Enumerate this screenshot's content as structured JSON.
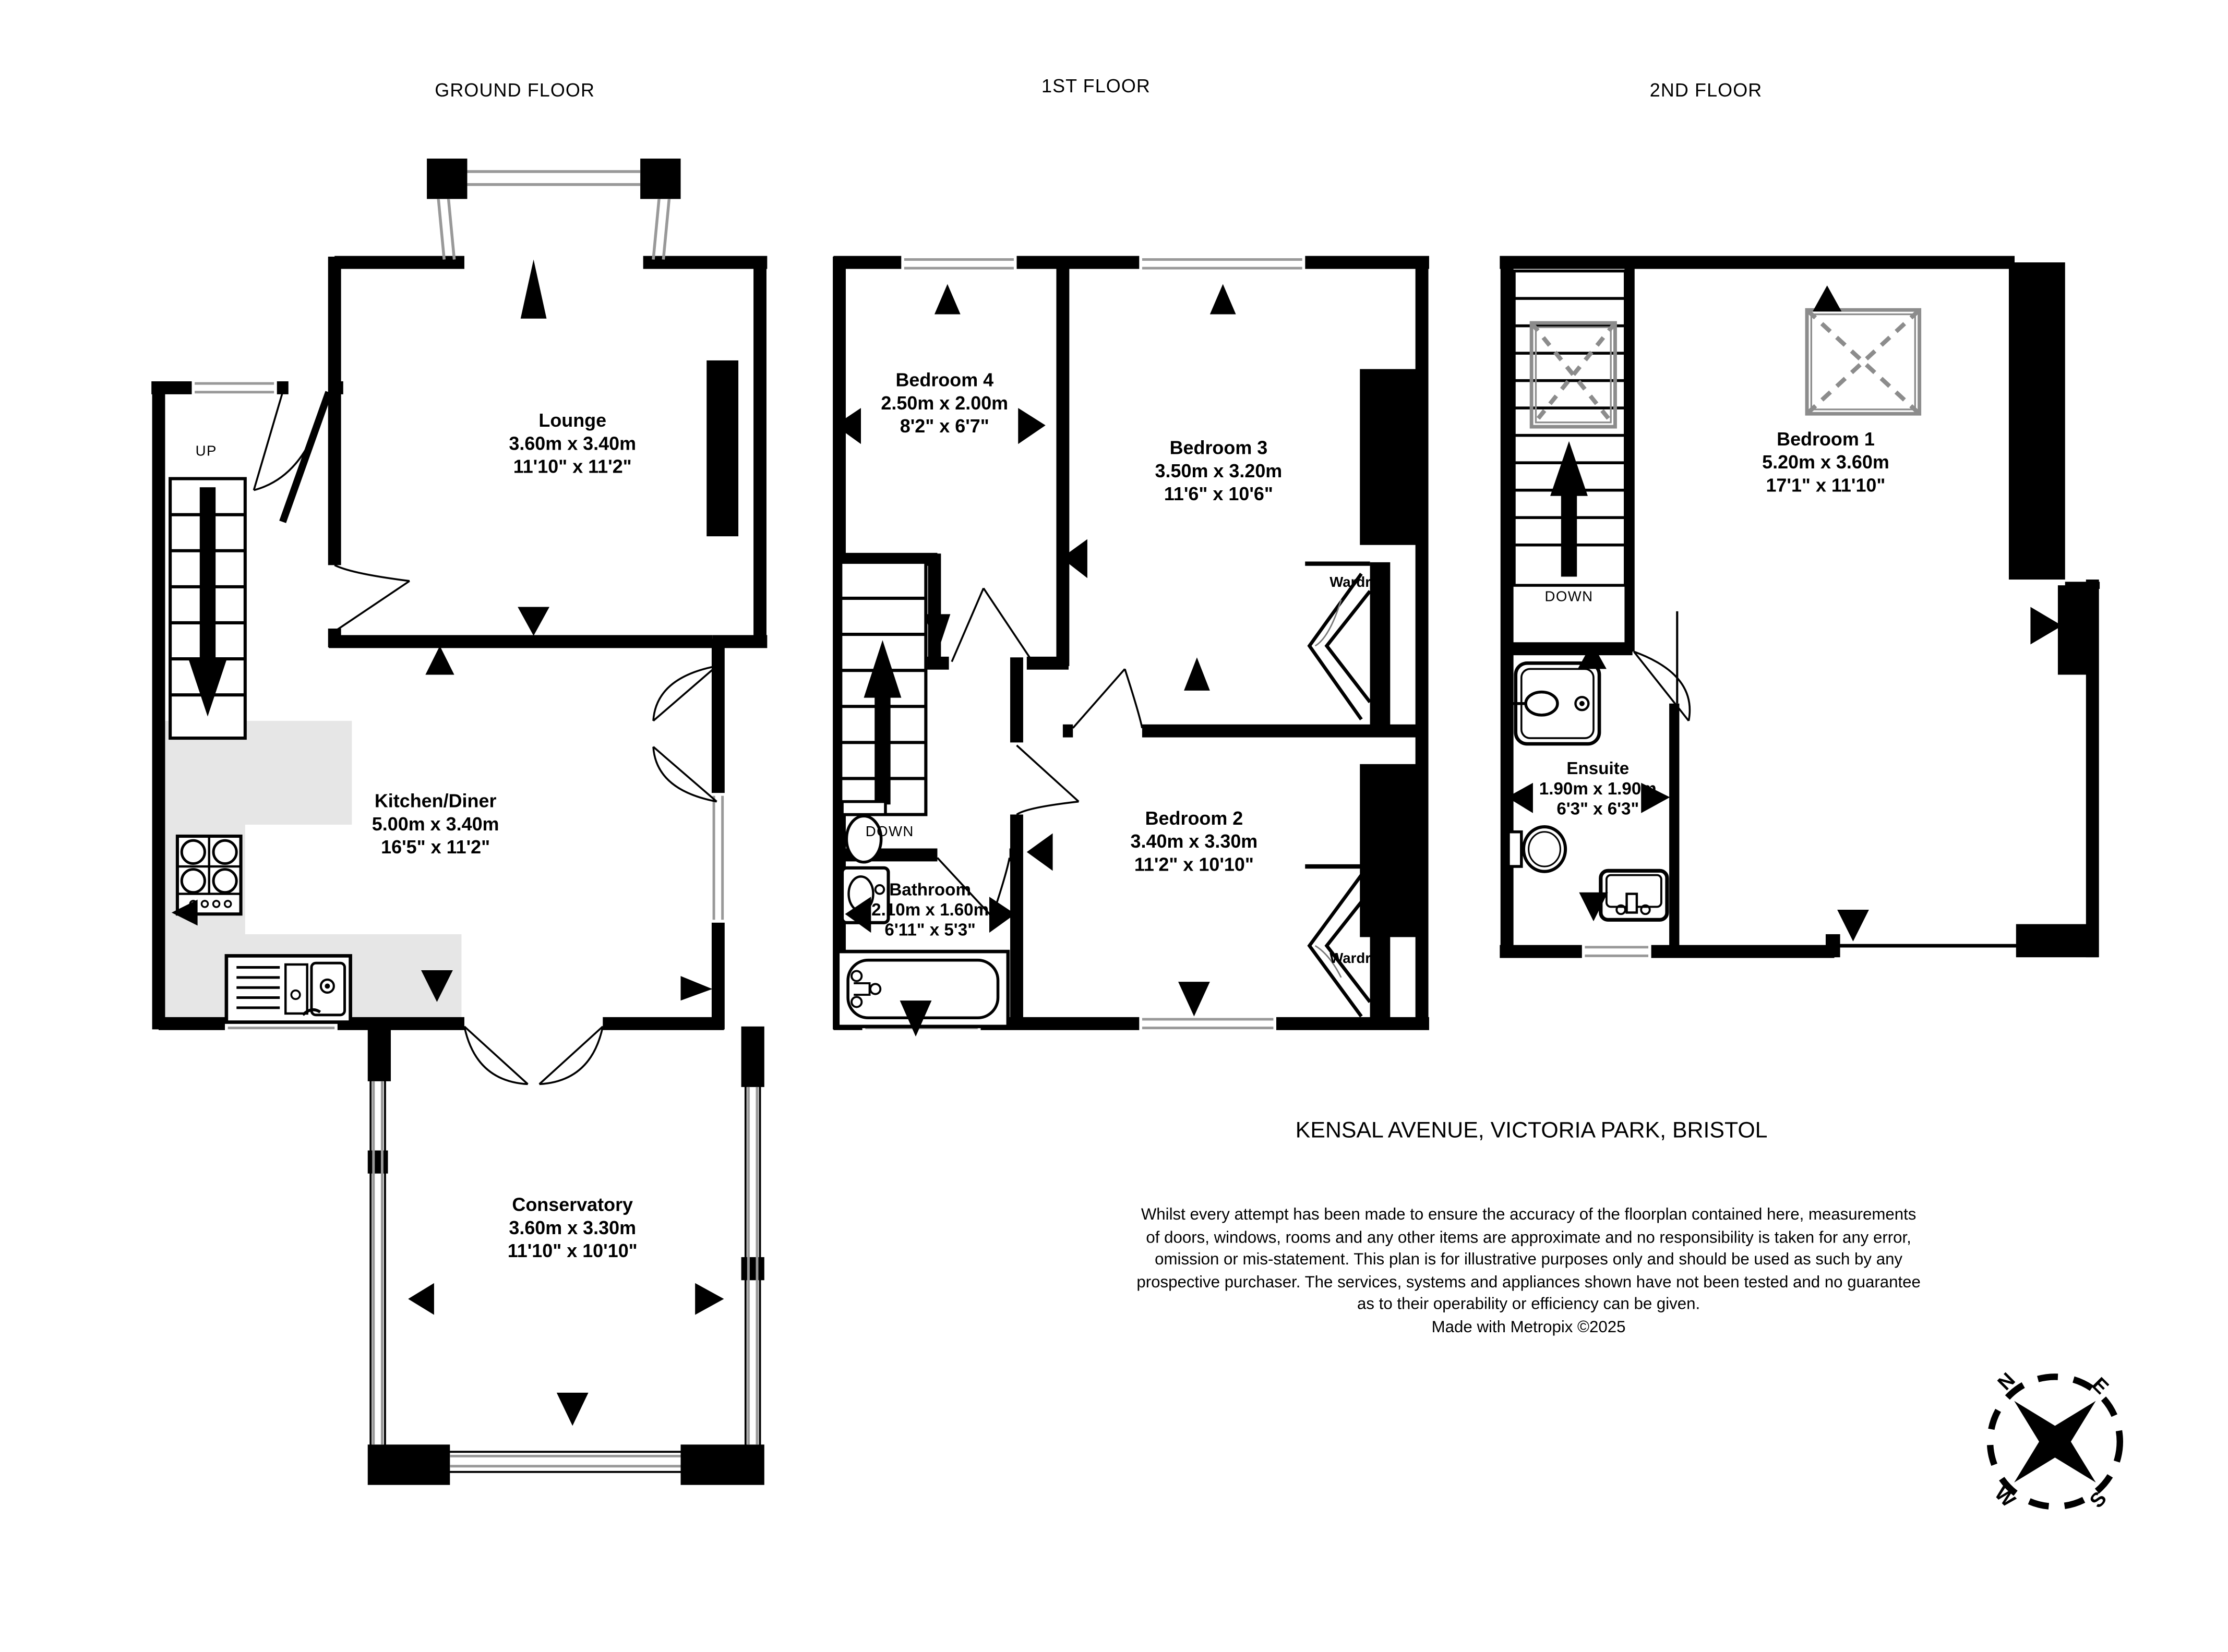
{
  "floors": [
    {
      "title": "GROUND FLOOR",
      "stair_label": "UP",
      "rooms": [
        {
          "name": "Lounge",
          "metric": "3.60m  x 3.40m",
          "imperial": "11'10\"  x 11'2\""
        },
        {
          "name": "Kitchen/Diner",
          "metric": "5.00m  x 3.40m",
          "imperial": "16'5\"  x 11'2\""
        },
        {
          "name": "Conservatory",
          "metric": "3.60m  x 3.30m",
          "imperial": "11'10\"  x 10'10\""
        }
      ]
    },
    {
      "title": "1ST FLOOR",
      "stair_label": "DOWN",
      "wardrobe_top": "Wardrobe",
      "wardrobe_bottom": "Wardrobe",
      "rooms": [
        {
          "name": "Bedroom 4",
          "metric": "2.50m  x 2.00m",
          "imperial": "8'2\"  x 6'7\""
        },
        {
          "name": "Bedroom 3",
          "metric": "3.50m  x 3.20m",
          "imperial": "11'6\"  x 10'6\""
        },
        {
          "name": "Bedroom 2",
          "metric": "3.40m  x 3.30m",
          "imperial": "11'2\"  x 10'10\""
        },
        {
          "name": "Bathroom",
          "metric": "2.10m  x 1.60m",
          "imperial": "6'11\"  x 5'3\""
        }
      ]
    },
    {
      "title": "2ND FLOOR",
      "stair_label": "DOWN",
      "rooms": [
        {
          "name": "Bedroom 1",
          "metric": "5.20m  x 3.60m",
          "imperial": "17'1\"  x 11'10\""
        },
        {
          "name": "Ensuite",
          "metric": "1.90m  x 1.90m",
          "imperial": "6'3\"  x 6'3\""
        }
      ]
    }
  ],
  "address": "KENSAL AVENUE, VICTORIA PARK, BRISTOL",
  "disclaimer_lines": [
    "Whilst every attempt has been made to ensure the accuracy of the floorplan contained here, measurements",
    "of doors, windows, rooms and any other items are approximate and no responsibility is taken for any error,",
    "omission or mis-statement. This plan is for illustrative purposes only and should be used as such by any",
    "prospective purchaser. The services, systems and appliances shown have not been tested and no guarantee",
    "as to their operability or efficiency can be given.",
    "Made with Metropix ©2025"
  ],
  "compass": {
    "north": "N",
    "east": "E",
    "south": "S",
    "west": "W"
  },
  "colors": {
    "wall": "#000000",
    "window_line": "#999999",
    "counter": "#e6e6e6",
    "skylight": "#8c8c8c"
  }
}
